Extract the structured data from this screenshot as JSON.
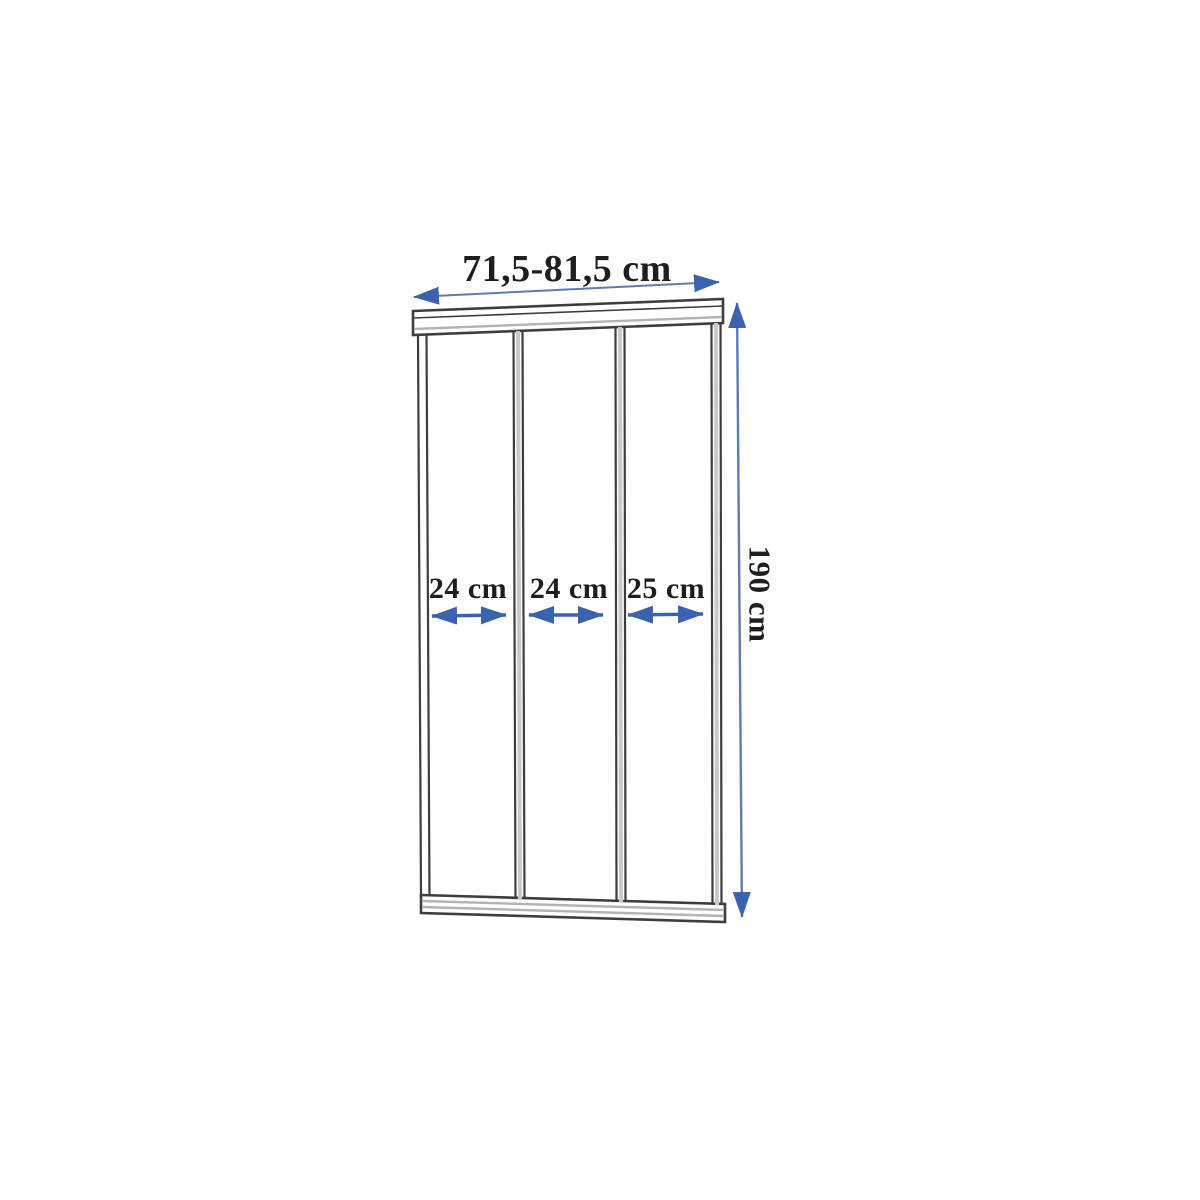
{
  "diagram": {
    "subject": "three-panel-sliding-shower-door-dimension-diagram",
    "panel_count": 3,
    "width_label": "71,5-81,5 cm",
    "height_label": "190 cm",
    "panel_labels": [
      "24 cm",
      "24 cm",
      "25 cm"
    ]
  },
  "colors": {
    "background": "#ffffff",
    "frame_line": "#3d3d3d",
    "frame_fill": "#ffffff",
    "rail_stripe": "#b3b3b3",
    "center_stripe": "#c9c9c9",
    "arrow": "#3a62ae",
    "arrow_shaft": "#5f7cb0",
    "text": "#1e1e1e"
  }
}
